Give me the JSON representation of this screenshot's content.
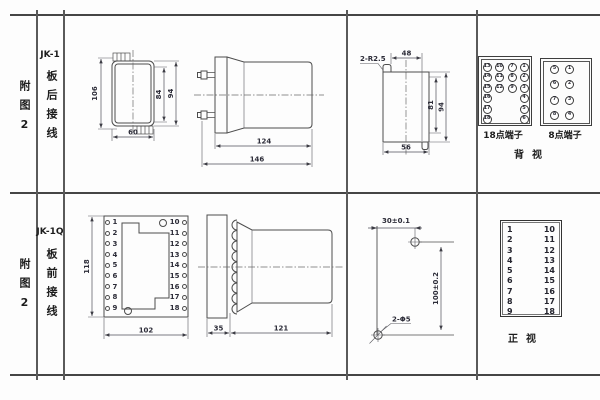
{
  "rows": {
    "r1": {
      "figure": "附图2",
      "model": "JK-1",
      "wiring": "板后接线"
    },
    "r2": {
      "figure": "附图2",
      "model": "JK-1Q",
      "wiring": "板前接线"
    }
  },
  "top": {
    "case_front": {
      "h_outer": "106",
      "h_inner": "84",
      "h_mid": "94",
      "w": "60"
    },
    "case_side": {
      "body_len": "124",
      "total_len": "146"
    },
    "cutout": {
      "note": "2-R2.5",
      "w_top": "48",
      "h_inner": "81",
      "h_outer": "94",
      "w_bottom": "56"
    },
    "t18": {
      "label": "18点端子",
      "col1": [
        13,
        14,
        15,
        16,
        17,
        18
      ],
      "col2": [
        10,
        11,
        12
      ],
      "col3": [
        7,
        8,
        9
      ],
      "col4": [
        1,
        2,
        3,
        4,
        5,
        6
      ]
    },
    "t8": {
      "label": "8点端子",
      "col1": [
        5,
        6,
        7,
        8
      ],
      "col2": [
        1,
        2,
        3,
        4
      ]
    },
    "view": "背视"
  },
  "bottom": {
    "panel_front": {
      "h": "118",
      "w": "102",
      "left": [
        1,
        2,
        3,
        4,
        5,
        6,
        7,
        8,
        9
      ],
      "right": [
        10,
        11,
        12,
        13,
        14,
        15,
        16,
        17,
        18
      ]
    },
    "panel_side": {
      "plate": "35",
      "body_len": "121"
    },
    "drill": {
      "w": "30±0.1",
      "h": "100±0.2",
      "holes": "2-Φ5"
    },
    "tlist": {
      "left": [
        1,
        2,
        3,
        4,
        5,
        6,
        7,
        8,
        9
      ],
      "right": [
        10,
        11,
        12,
        13,
        14,
        15,
        16,
        17,
        18
      ],
      "view": "正视"
    }
  }
}
